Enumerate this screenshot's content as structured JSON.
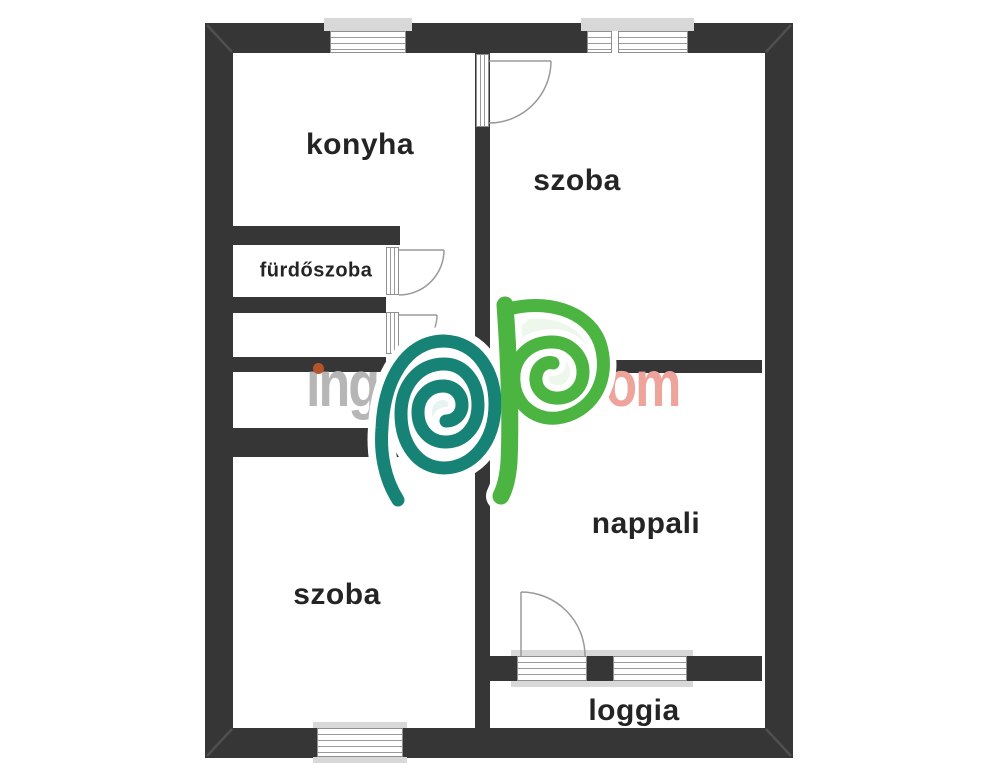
{
  "rooms": {
    "konyha": {
      "label": "konyha"
    },
    "szoba_top": {
      "label": "szoba"
    },
    "furdoszoba": {
      "label": "fürdőszoba"
    },
    "szoba_bottom": {
      "label": "szoba"
    },
    "nappali": {
      "label": "nappali"
    },
    "loggia": {
      "label": "loggia"
    }
  },
  "watermark": {
    "prefix": "ıng",
    "dot": ".",
    "suffix": "com"
  },
  "colors": {
    "wall": "#363636",
    "sill": "#d8d8d8",
    "frame_line": "#9a9a9a",
    "arc_line": "#9a9a9a",
    "miter_line": "#4f4f4f",
    "label_text": "#242424",
    "watermark_gray": "#b6b6b6",
    "watermark_salmon": "#efa49b",
    "watermark_period_red": "#b44b33",
    "watermark_idot_orange": "#b5532c",
    "logo_teal": "#178376",
    "logo_green": "#4cb440",
    "logo_teal_fill": "#e7f3f1",
    "logo_green_fill": "#edf7ec",
    "halo_white": "#ffffff"
  }
}
